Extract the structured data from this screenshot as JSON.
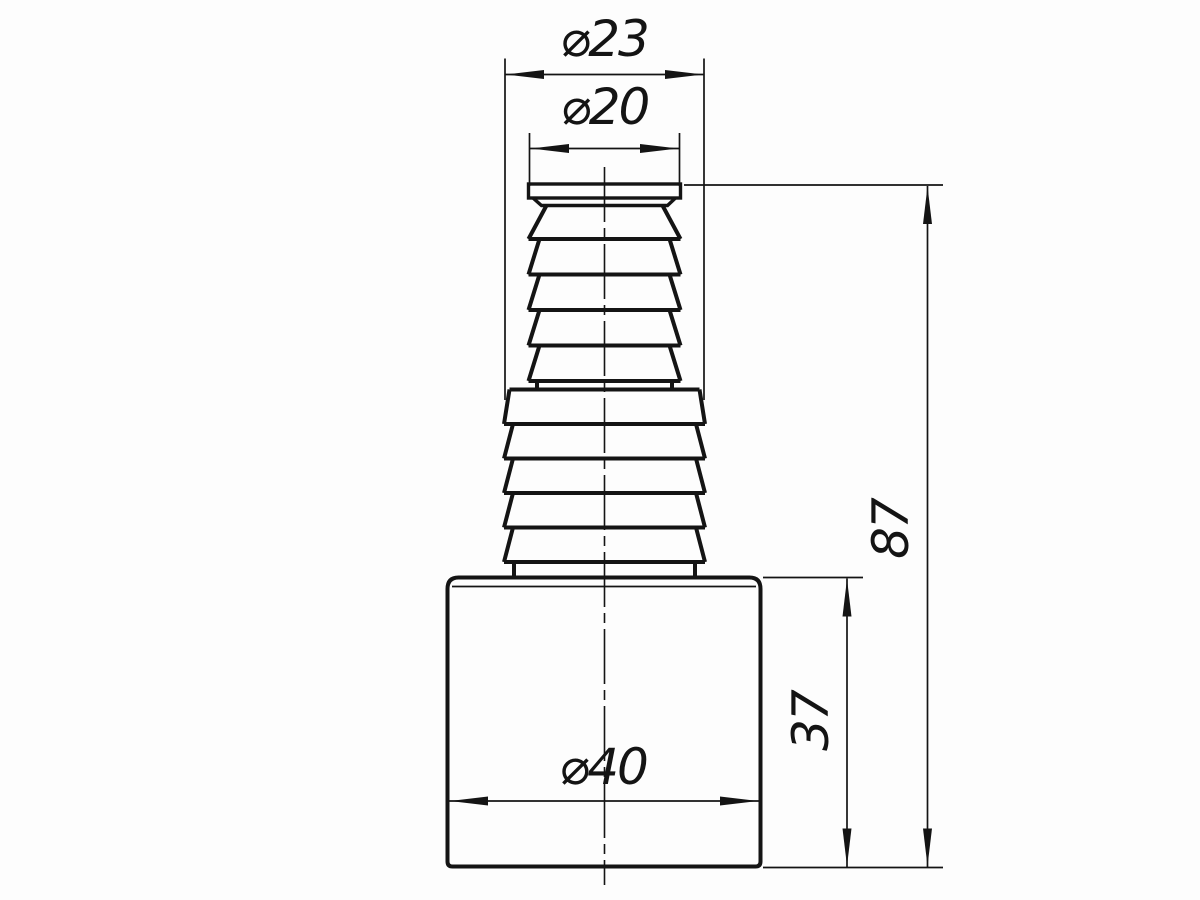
{
  "page": {
    "background": "#fdfdfd",
    "line_color": "#141414"
  },
  "drawing": {
    "type": "technical-drawing",
    "view": "front view, barbed stepped hose adapter",
    "dimensions": [
      {
        "id": "dia23",
        "label": "⌀23",
        "value": 23,
        "kind": "diameter"
      },
      {
        "id": "dia20",
        "label": "⌀20",
        "value": 20,
        "kind": "diameter"
      },
      {
        "id": "dia40",
        "label": "⌀40",
        "value": 40,
        "kind": "diameter"
      },
      {
        "id": "h87",
        "label": "87",
        "value": 87,
        "kind": "linear-vertical"
      },
      {
        "id": "h37",
        "label": "37",
        "value": 37,
        "kind": "linear-vertical"
      }
    ]
  }
}
